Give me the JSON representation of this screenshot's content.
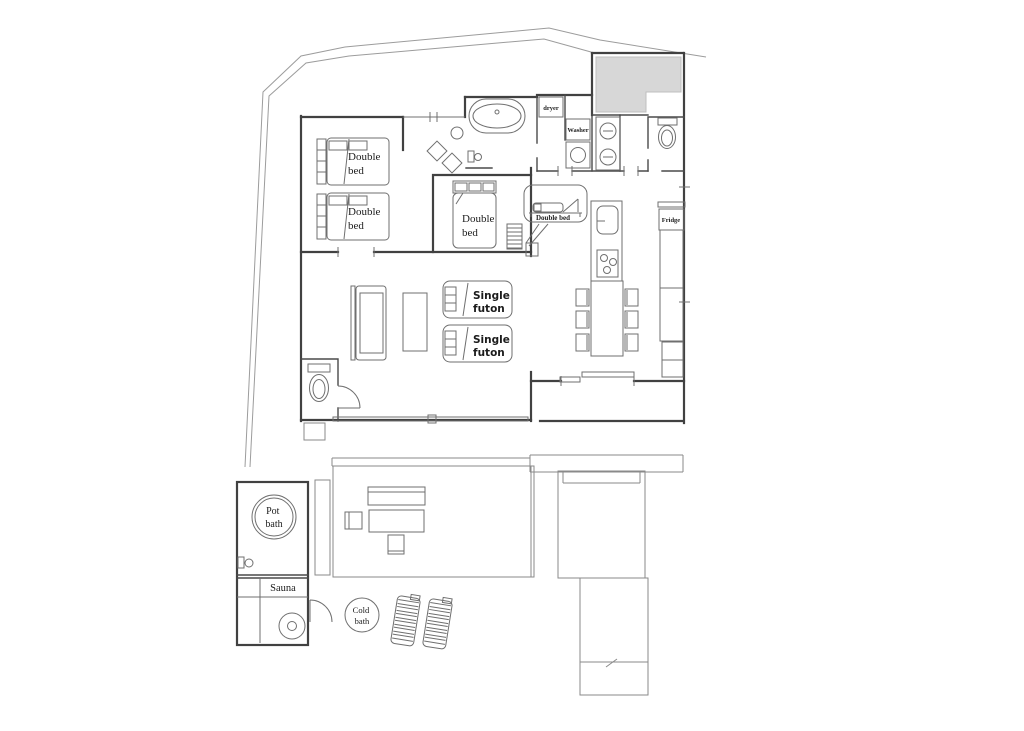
{
  "figure": {
    "type": "floor-plan",
    "description": "Architectural floor plan of a villa with bedrooms, loft, kitchen-dining, bathroom block, outdoor onsen deck with pot bath, sauna and cold bath"
  },
  "colors": {
    "background": "#ffffff",
    "wall": "#414141",
    "furniture_line": "#6f6f6f",
    "boundary_line": "#9c9c9c",
    "entrance_fill": "#d7d7d7",
    "text": "#1b1b1b"
  },
  "labels": {
    "double_bed": [
      "Double",
      "bed"
    ],
    "single_futon": [
      "Single",
      "futon"
    ],
    "loft_double_bed": "Double bed",
    "dryer": "dryer",
    "washer": "Washer",
    "fridge": "Fridge",
    "pot_bath": [
      "Pot",
      "bath"
    ],
    "sauna": "Sauna",
    "cold_bath": [
      "Cold",
      "bath"
    ]
  }
}
